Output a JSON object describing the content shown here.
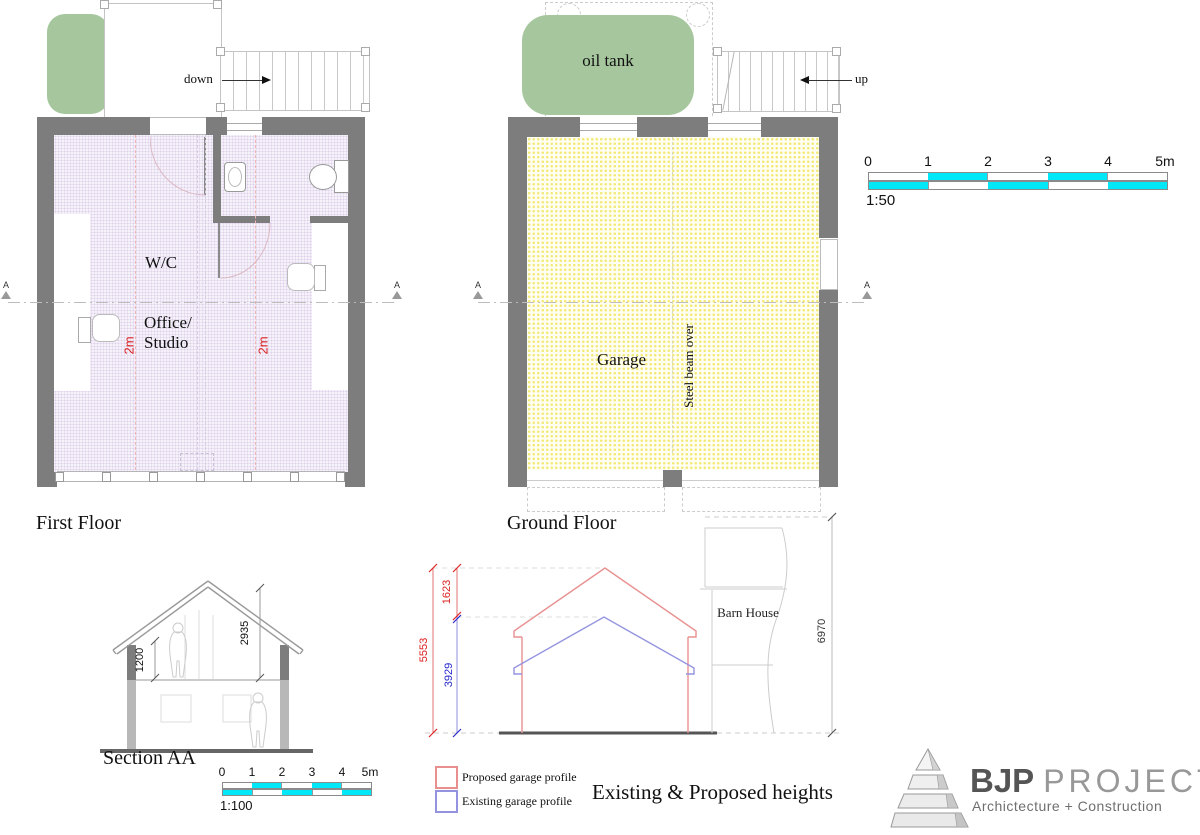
{
  "first_floor": {
    "title": "First Floor",
    "stair_label": "down",
    "room_labels": {
      "wc": "W/C",
      "office1": "Office/",
      "office2": "Studio"
    },
    "headroom_left": "2m",
    "headroom_right": "2m",
    "section_marker": "A"
  },
  "ground_floor": {
    "title": "Ground Floor",
    "stair_label": "up",
    "oil_tank": "oil tank",
    "room_label": "Garage",
    "beam_note": "Steel beam over",
    "section_marker": "A"
  },
  "scale_bar_50": {
    "ratio": "1:50",
    "ticks": [
      "0",
      "1",
      "2",
      "3",
      "4",
      "5m"
    ]
  },
  "scale_bar_100": {
    "ratio": "1:100",
    "ticks": [
      "0",
      "1",
      "2",
      "3",
      "4",
      "5m"
    ]
  },
  "section": {
    "title": "Section AA",
    "dim_sill": "1200",
    "dim_roof": "2935"
  },
  "heights": {
    "title": "Existing & Proposed heights",
    "dim_increase": "1623",
    "dim_proposed_total": "5553",
    "dim_existing_ridge": "3929",
    "dim_barn_house": "6970",
    "barn_label": "Barn House",
    "legend_proposed": "Proposed garage profile",
    "legend_existing": "Existing garage profile"
  },
  "logo": {
    "brand_bold": "BJP",
    "brand_light": "PROJECTS",
    "tagline": "Archictecture + Construction"
  },
  "colors": {
    "wall": "#7d7d7d",
    "floor_first_dots": "#ddd2ea",
    "floor_ground_dots": "#f3ea7a",
    "tank_green": "#a6c79e",
    "scale_cyan": "#00e8f8",
    "proposed_red_line": "#e89090",
    "existing_blue_line": "#9393e0",
    "dim_red": "#dd2222",
    "dim_blue": "#2a2acc"
  }
}
